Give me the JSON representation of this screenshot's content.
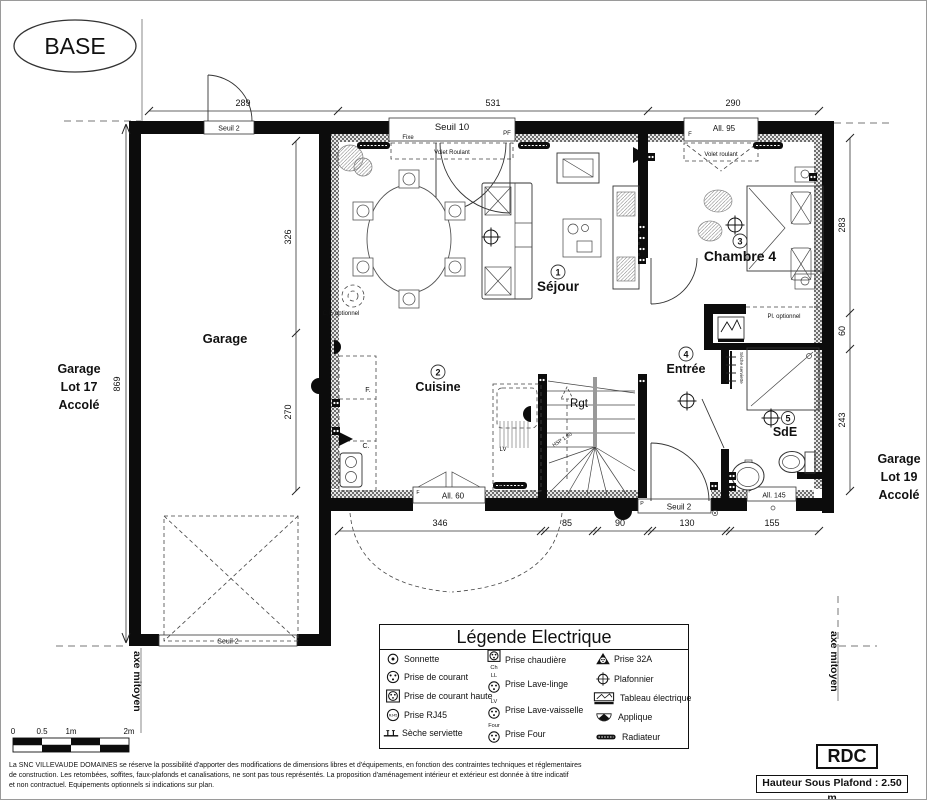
{
  "base_label": "BASE",
  "rooms": [
    {
      "num": "1",
      "name": "Séjour"
    },
    {
      "num": "2",
      "name": "Cuisine"
    },
    {
      "num": "3",
      "name": "Chambre 4"
    },
    {
      "num": "4",
      "name": "Entrée"
    },
    {
      "num": "5",
      "name": "SdE"
    }
  ],
  "areas": {
    "garage": "Garage",
    "rgt": "Rgt",
    "hsp": "HSP 1.80"
  },
  "side_labels": {
    "left": [
      "Garage",
      "Lot 17",
      "Accolé"
    ],
    "right": [
      "Garage",
      "Lot 19",
      "Accolé"
    ],
    "axe_left": "axe mitoyen",
    "axe_right": "axe mitoyen"
  },
  "dimensions": {
    "top": [
      "289",
      "531",
      "290"
    ],
    "left_outer": "869",
    "left_inner": [
      "326",
      "270"
    ],
    "right": [
      "283",
      "60",
      "243"
    ],
    "bottom": [
      "346",
      "85",
      "90",
      "130",
      "155"
    ]
  },
  "openings": {
    "garage_top": "Seuil 2",
    "garage_bottom": "Seuil 2",
    "sejour": {
      "main": "Seuil 10",
      "left": "Fixe",
      "right": "PF",
      "shutter": "Volet Roulant"
    },
    "chambre": {
      "main": "All. 95",
      "left": "F",
      "shutter": "Volet roulant"
    },
    "cuisine": {
      "main": "All. 60",
      "left": "F"
    },
    "entree": {
      "main": "Seuil 2",
      "left": "P"
    },
    "sde": {
      "main": "All. 145",
      "left": "F"
    }
  },
  "annotations": {
    "cf_optionnel": "C,F, optionnel",
    "pl_optionnel": "Pl. optionnel",
    "seche_serviette": "Sèche serviette",
    "kitchen_f": "F.",
    "kitchen_c": "C.",
    "kitchen_lv": "LV",
    "kitchen_ll": "LL"
  },
  "scale_bar": {
    "ticks": [
      "0",
      "0.5",
      "1m",
      "2m"
    ]
  },
  "legend": {
    "title": "Légende Electrique",
    "col1": [
      {
        "label": "Sonnette"
      },
      {
        "label": "Prise de courant"
      },
      {
        "label": "Prise de courant haute"
      },
      {
        "label": "Prise RJ45",
        "icon_text": "RJ45"
      },
      {
        "label": "Sèche serviette"
      }
    ],
    "col2": [
      {
        "tag": "Ch",
        "label": "Prise chaudière"
      },
      {
        "tag": "LL",
        "label": "Prise Lave-linge"
      },
      {
        "tag": "LV",
        "label": "Prise Lave-vaisselle"
      },
      {
        "tag": "Four",
        "label": "Prise Four"
      }
    ],
    "col3": [
      {
        "label": "Prise 32A"
      },
      {
        "label": "Plafonnier"
      },
      {
        "label": "Tableau électrique"
      },
      {
        "label": "Applique"
      },
      {
        "label": "Radiateur"
      }
    ]
  },
  "footer": {
    "disclaimer_line1": "La SNC VILLEVAUDE DOMAINES se réserve la possibilité d'apporter des modifications de dimensions libres et d'équipements, en fonction des contraintes techniques et réglementaires",
    "disclaimer_line2": "de construction. Les retombées, soffites, faux-plafonds et canalisations, ne sont pas tous représentés. La proposition d'aménagement intérieur et extérieur est donnée à titre indicatif",
    "disclaimer_line3": "et non contractuel. Equipements optionnels si indications sur plan.",
    "level_label": "RDC",
    "ceiling_height": "Hauteur Sous Plafond : 2.50 m"
  }
}
